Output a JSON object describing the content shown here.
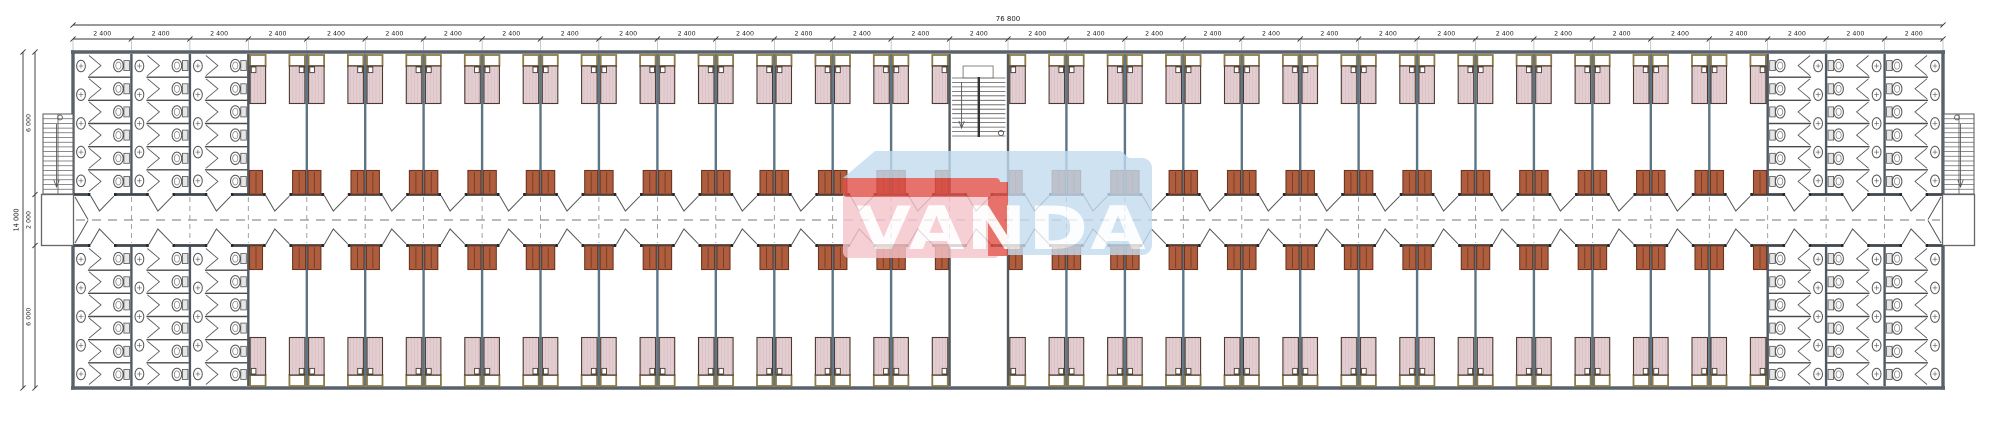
{
  "drawing": {
    "title": "dormitory-container-floor-plan",
    "watermark_text": "VANDA"
  },
  "dimensions": {
    "top_total_label": "76 800",
    "top_bay_label": "2 400",
    "top_bay_count": 32,
    "left_total_label": "14 000",
    "left_segment_labels": [
      "6 000",
      "2 000",
      "6 000"
    ]
  },
  "plan": {
    "bay_count": 32,
    "bathroom_bays_left": 3,
    "bathroom_bays_right": 3,
    "interior_stair_bay_index": 15,
    "rooms_top_band": 25,
    "rooms_bottom_band": 24,
    "beds_per_room": 2,
    "toilet_stalls_per_column": 6,
    "sinks_per_column": 5
  },
  "colors": {
    "wall": "#59626b",
    "partition": "#3e464e",
    "module_wall": "#5d7585",
    "bed_fill": "#e4cfd3",
    "bed_outline": "#4a3b31",
    "headboard_outline": "#8d7b48",
    "wardrobe_fill": "#ae5e3e",
    "wardrobe_outline": "#6d351d",
    "fixture_outline": "#555555",
    "dimension_color": "#1c1c1c",
    "watermark_pink": "#f5c4cb",
    "watermark_red": "#e25048",
    "watermark_blue": "#c3dcf0",
    "watermark_letter": "#ffffff"
  }
}
